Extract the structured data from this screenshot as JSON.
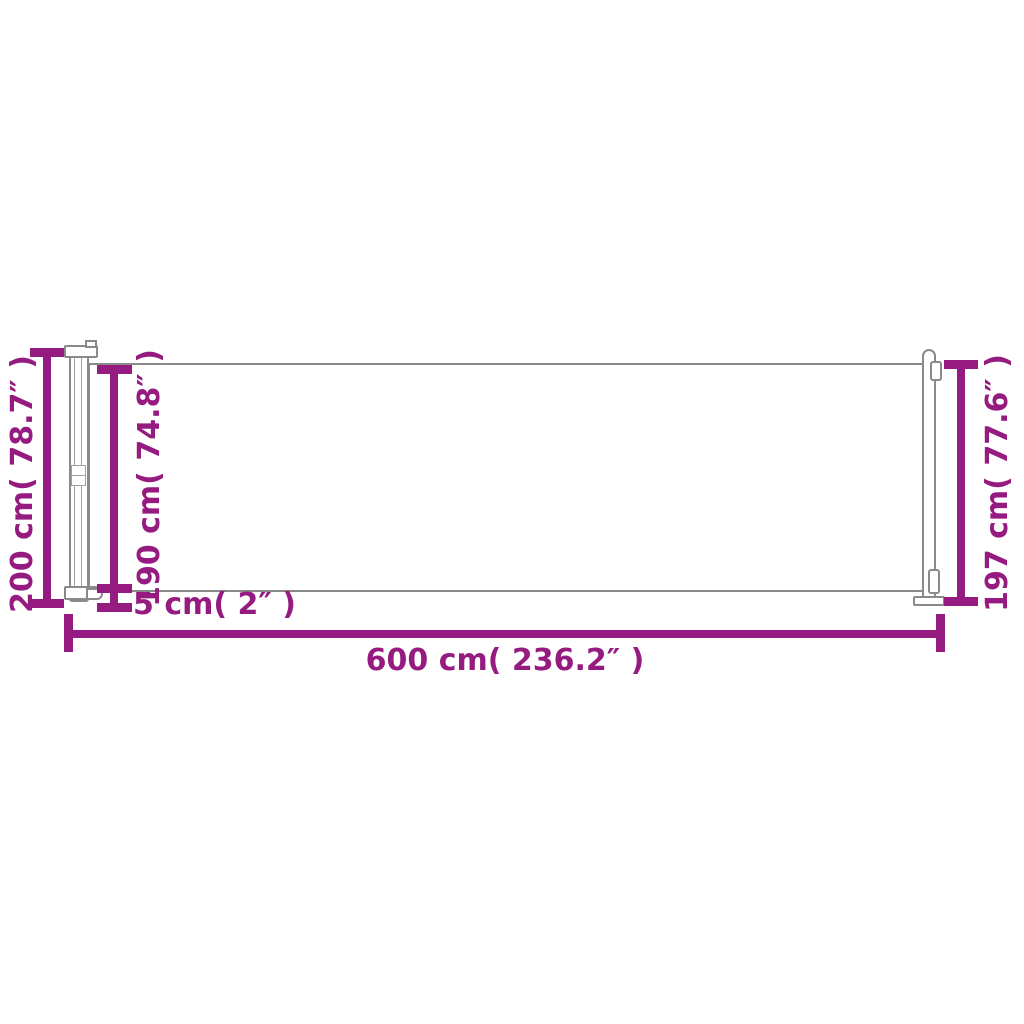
{
  "colors": {
    "accent": "#951B81",
    "outline": "#8a8a8a",
    "bg": "#ffffff"
  },
  "diagram": {
    "labels": {
      "total_height": "200 cm( 78.7″ )",
      "fabric_height": "190 cm( 74.8″ )",
      "ground_clearance": "5 cm( 2″ )",
      "total_width": "600 cm( 236.2″ )",
      "post_height": "197 cm( 77.6″ )"
    }
  }
}
